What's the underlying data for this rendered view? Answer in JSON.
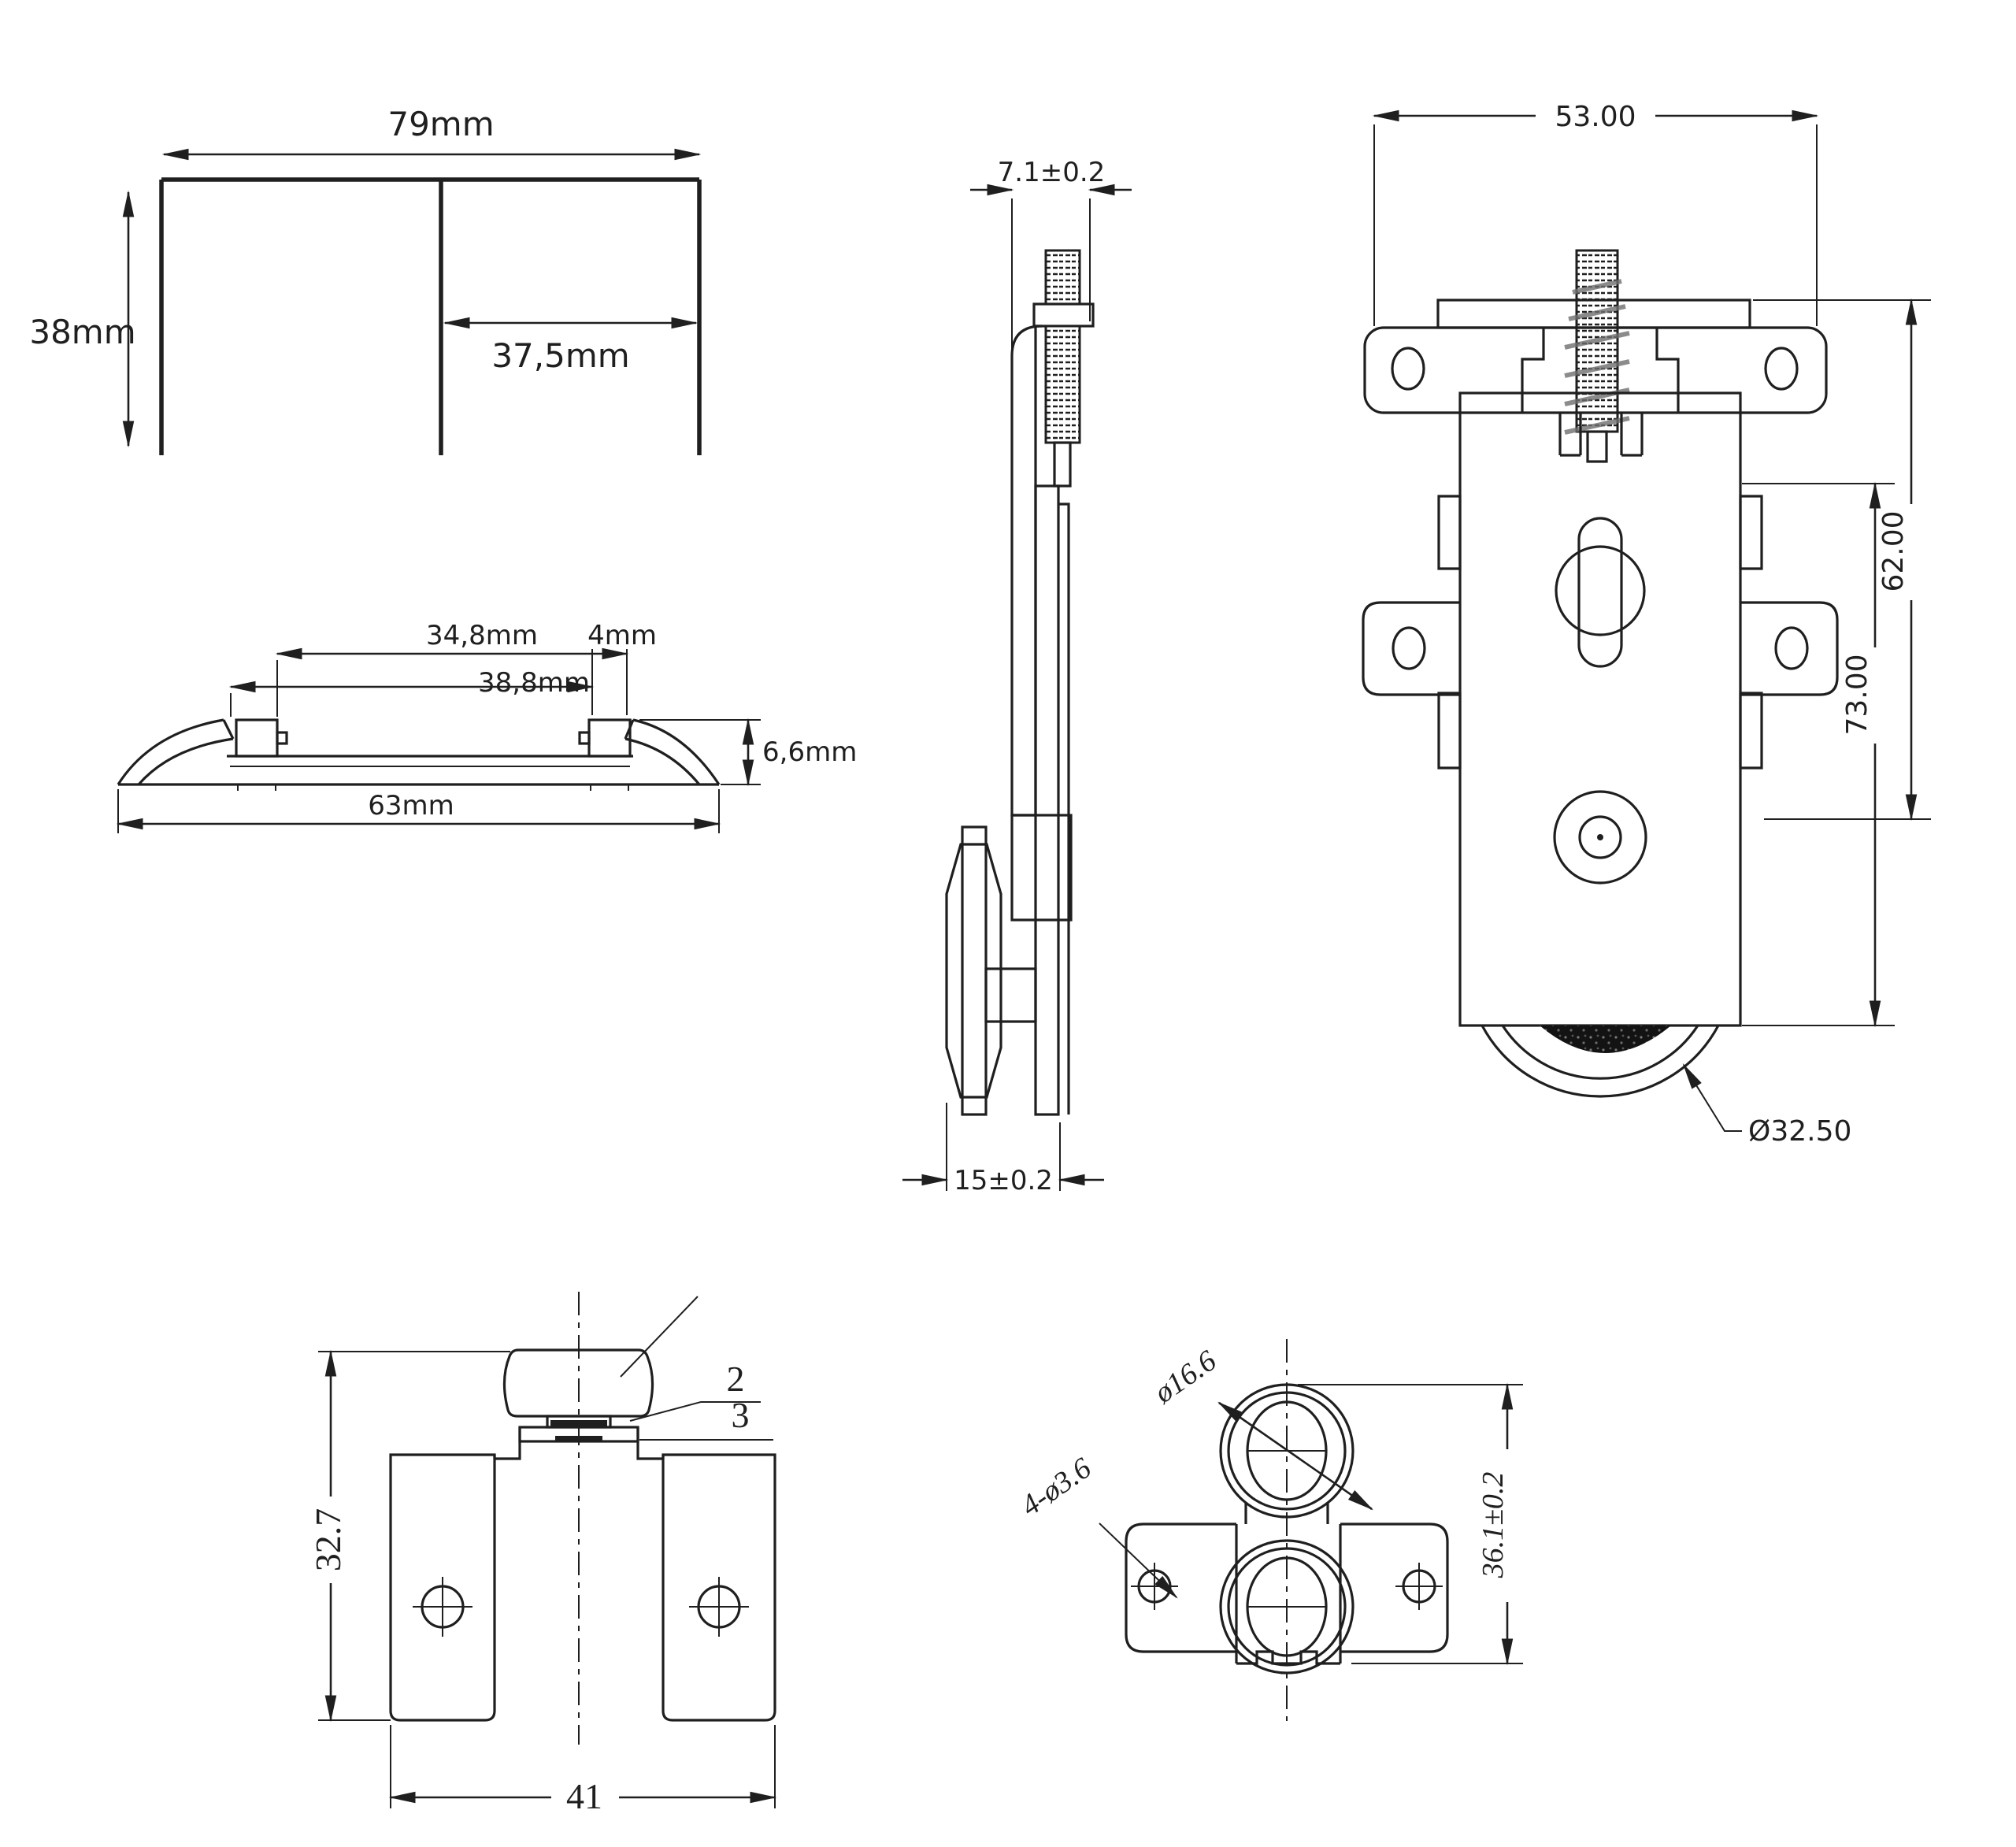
{
  "sheet": {
    "background": "#ffffff",
    "line_color": "#1f1f1f"
  },
  "top_track_profile": {
    "width": "79mm",
    "height": "38mm",
    "channel_width": "37,5mm"
  },
  "bottom_rail_profile": {
    "inner_span": "34,8mm",
    "rail_width": "4mm",
    "outer_span": "38,8mm",
    "height": "6,6mm",
    "total_width": "63mm"
  },
  "roller_side_view": {
    "stud_offset": "7.1±0.2",
    "thickness": "15±0.2"
  },
  "roller_front_view": {
    "plate_width": "53.00",
    "upper_height": "62.00",
    "overall_height": "73.00",
    "wheel_diameter": "Ø32.50"
  },
  "bottom_bracket_view": {
    "height": "32.7",
    "width": "41",
    "callout_washer": "2",
    "callout_pad": "3"
  },
  "twin_guide_view": {
    "roller_diameter": "ø16.6",
    "mount_holes": "4-ø3.6",
    "height": "36.1±0.2"
  }
}
